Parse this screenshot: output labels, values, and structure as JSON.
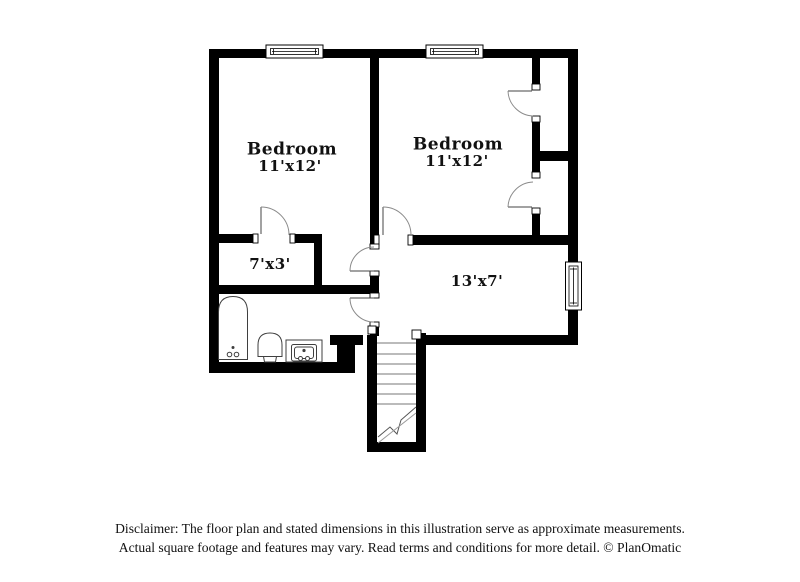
{
  "title": "Floor plan illustration",
  "rooms": [
    {
      "name": "Bedroom",
      "dims": "11'x12'"
    },
    {
      "name": "Bedroom",
      "dims": "11'x12'"
    },
    {
      "name": "",
      "dims": "7'x3'"
    },
    {
      "name": "",
      "dims": "13'x7'"
    }
  ],
  "fixtures": {
    "bathtub": "bathtub",
    "toilet": "toilet",
    "sink": "sink-vanity",
    "stairs": "staircase"
  },
  "disclaimer": {
    "line1": "Disclaimer: The floor plan and stated dimensions in this illustration serve as approximate measurements.",
    "line2": "Actual square footage and features may vary. Read terms and conditions for more detail. © PlanOmatic"
  },
  "colors": {
    "wall": "#000000",
    "fixture_outline": "#3f3f3f",
    "door_arc": "#8a8a8a",
    "tread_line": "#777777",
    "text": "#111111",
    "background": "#ffffff"
  }
}
